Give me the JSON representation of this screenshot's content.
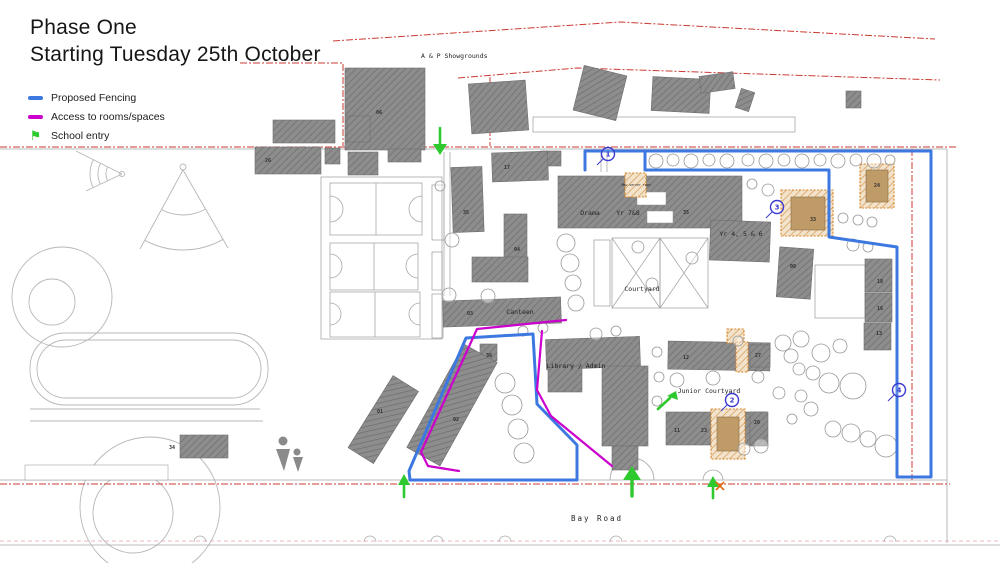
{
  "title": {
    "line1": "Phase One",
    "line2": "Starting Tuesday 25th October"
  },
  "legend": {
    "items": [
      {
        "label": "Proposed Fencing",
        "type": "line",
        "color": "#3c78e0"
      },
      {
        "label": "Access to rooms/spaces",
        "type": "line",
        "color": "#cc00cc"
      },
      {
        "label": "School entry",
        "type": "flag",
        "color": "#2ec92e"
      }
    ],
    "flag_glyph": "⚑"
  },
  "map": {
    "colors": {
      "fence": "#3c78e0",
      "access": "#cc00cc",
      "entry": "#2ec92e",
      "boundary": "#cc3b33",
      "marker": "#3a3ad0",
      "highlight": "#d9882f",
      "building_fill": "#8d8d8d"
    },
    "labels": {
      "showgrounds": "A & P Showgrounds",
      "bay_road": "Bay Road",
      "drama": "Drama",
      "yr78": "Yr 7&8",
      "yr456": "Yr 4, 5 & 6",
      "courtyard": "Courtyard",
      "canteen": "Canteen",
      "library": "Library / Admin",
      "junior_courtyard": "Junior Courtyard",
      "new_server_room": "New server room"
    },
    "building_numbers": {
      "b06": "06",
      "b26": "26",
      "b34": "34",
      "b01": "01",
      "b02": "02",
      "b36": "36",
      "b35": "35",
      "b17": "17",
      "b04": "04",
      "b03": "03",
      "b35b": "35",
      "b24": "24",
      "b33": "33",
      "b08": "08",
      "b18": "18",
      "b16": "16",
      "b13": "13",
      "b12": "12",
      "b27": "27",
      "b20": "20",
      "b11": "11",
      "b23": "23"
    },
    "markers": {
      "m1": "1",
      "m2": "2",
      "m3": "3",
      "m4": "4"
    }
  }
}
